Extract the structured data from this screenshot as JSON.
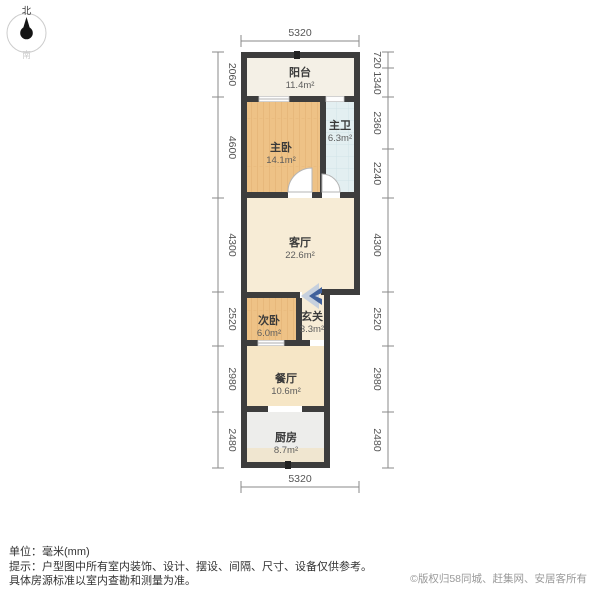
{
  "compass": {
    "north": "北",
    "south": "南"
  },
  "plan": {
    "rooms": {
      "balcony": {
        "name": "阳台",
        "area": "11.4m²"
      },
      "master": {
        "name": "主卧",
        "area": "14.1m²"
      },
      "mbath": {
        "name": "主卫",
        "area": "6.3m²"
      },
      "living": {
        "name": "客厅",
        "area": "22.6m²"
      },
      "second": {
        "name": "次卧",
        "area": "6.0m²"
      },
      "entry": {
        "name": "玄关",
        "area": "3.3m²"
      },
      "dining": {
        "name": "餐厅",
        "area": "10.6m²"
      },
      "kitchen": {
        "name": "厨房",
        "area": "8.7m²"
      }
    },
    "dims": {
      "top": "5320",
      "bottom": "5320",
      "left": [
        "2060",
        "4600",
        "4300",
        "2520",
        "2980",
        "2480"
      ],
      "right": [
        "720",
        "1340",
        "2360",
        "2240",
        "4300",
        "2520",
        "2980",
        "2480"
      ]
    }
  },
  "colors": {
    "wall": "#3d3d3d",
    "wood_floor": "#eec286",
    "wood_grain": "#e2b172",
    "tile_floor": "#e3eff1",
    "living_floor": "#f7ecd6",
    "entry_floor": "#f7ecd6",
    "dining_floor": "#f6e6c6",
    "kitchen_floor": "#ededeb",
    "kitchen_counter": "#f0e6d0",
    "balcony_floor": "#f4f0e6",
    "entry_arrow_light": "#c6d0de",
    "entry_arrow_dark": "#41619b"
  },
  "footer": {
    "unit_line": "单位：毫米(mm)",
    "tip_line1": "提示：户型图中所有室内装饰、设计、摆设、间隔、尺寸、设备仅供参考。",
    "tip_line2": "具体房源标准以室内查勘和测量为准。",
    "copyright": "©版权归58同城、赶集网、安居客所有"
  }
}
